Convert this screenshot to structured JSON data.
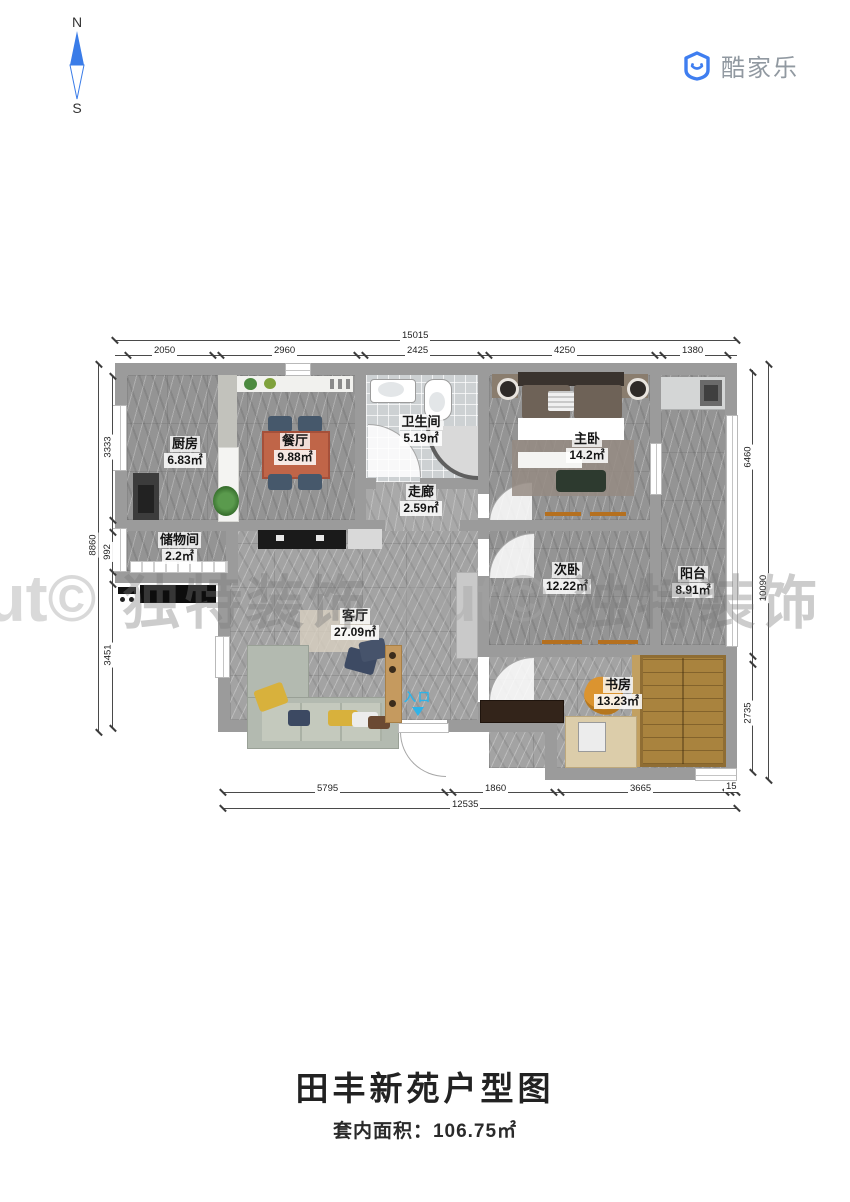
{
  "compass": {
    "north": "N",
    "south": "S"
  },
  "brand": {
    "name": "酷家乐"
  },
  "watermark": {
    "items": [
      "dut©",
      "独特装饰",
      "dut©",
      "独特装饰",
      "dut©",
      "独特装饰"
    ]
  },
  "plan": {
    "entrance_label": "入口",
    "rooms": [
      {
        "name": "厨房",
        "area": "6.83㎡"
      },
      {
        "name": "餐厅",
        "area": "9.88㎡"
      },
      {
        "name": "卫生间",
        "area": "5.19㎡"
      },
      {
        "name": "主卧",
        "area": "14.2㎡"
      },
      {
        "name": "阳台",
        "area": "8.91㎡"
      },
      {
        "name": "走廊",
        "area": "2.59㎡"
      },
      {
        "name": "储物间",
        "area": "2.2㎡"
      },
      {
        "name": "次卧",
        "area": "12.22㎡"
      },
      {
        "name": "客厅",
        "area": "27.09㎡"
      },
      {
        "name": "书房",
        "area": "13.23㎡"
      }
    ]
  },
  "dimensions": {
    "top": {
      "total": "15015",
      "segments": [
        "2050",
        "2960",
        "2425",
        "4250",
        "1380"
      ]
    },
    "left": {
      "total": "8860",
      "segments": [
        "3333",
        "992",
        "3451"
      ]
    },
    "right": {
      "total": "10090",
      "segments": [
        "6460",
        "2735"
      ]
    },
    "bottom": {
      "total": "12535",
      "segments": [
        "5795",
        "1860",
        "3665",
        "15"
      ]
    }
  },
  "footer": {
    "title": "田丰新苑户型图",
    "area_text": "套内面积：106.75㎡"
  }
}
